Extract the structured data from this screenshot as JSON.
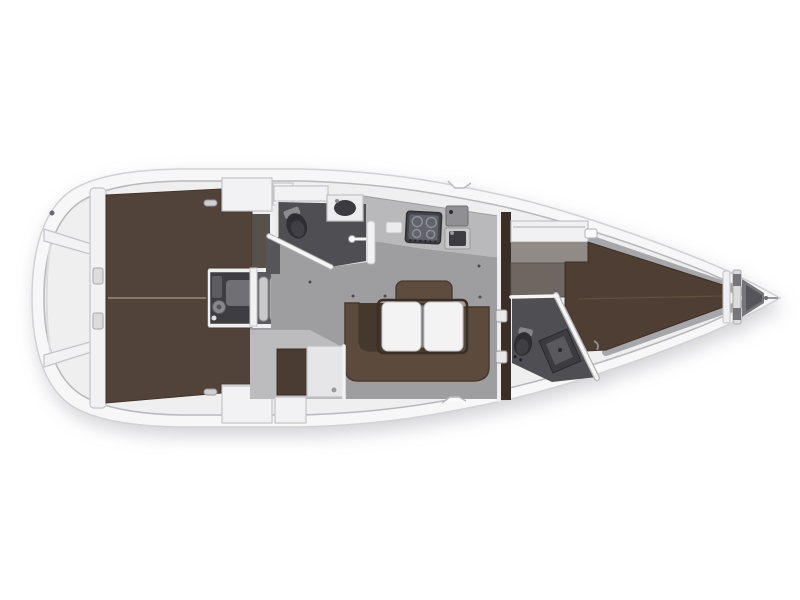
{
  "diagram": {
    "type": "sailing-yacht-interior-floor-plan",
    "view": "top-down",
    "orientation": "bow-right",
    "background": "#ffffff"
  },
  "colors": {
    "hull_white": "#f7f7f8",
    "hull_edge": "#d2d2d6",
    "deck_line": "#b9b9bd",
    "interior_base": "#efeff0",
    "wall_white": "#f2f2f4",
    "wall_stroke": "#c4c4c8",
    "floor_gray": "#9e9ea0",
    "floor_light": "#bcbcbe",
    "head_floor": "#4e4e53",
    "fixture_dark": "#2e2e33",
    "aft_berth_brown": "#52433a",
    "vberth_brown": "#4e3e34",
    "settee_brown": "#5c4a3c",
    "settee_footwell": "#45382c",
    "settee_edge": "#483a2e",
    "backrest_brown": "#5e4c3e",
    "bulkhead_brown": "#3b2e26",
    "nav_seat_brown": "#4b3c33",
    "table_white": "#f3f3f4",
    "counter_gray": "#b9b9bc",
    "stove_dark": "#44444a",
    "engine_dark": "#3e3e42",
    "steps_gray": "#c9c9cb",
    "hull_wall_gray": "#a7a7ab",
    "anchor_gray": "#77777b",
    "wardrobe_gray": "#6e6660",
    "seam_light": "#9a8a7c"
  },
  "vessel": {
    "stern": [
      "swim-platform",
      "transom-bulkhead",
      "stern-lockers"
    ],
    "aft_cabins": [
      "port-double-berth",
      "starboard-double-berth",
      "engine-compartment",
      "companionway-steps",
      "lockers"
    ],
    "saloon": [
      "u-shaped-settee",
      "folding-table",
      "backrest",
      "nav-seat",
      "nav-table",
      "cabin-sole"
    ],
    "galley": [
      "counter",
      "stove",
      "sink",
      "top-loading-fridge"
    ],
    "heads": [
      "aft-head-toilet",
      "aft-head-sink",
      "aft-head-shower-mixer",
      "forward-head-toilet",
      "forward-head-sink"
    ],
    "forward_cabin": [
      "v-berth",
      "shelf",
      "wardrobe",
      "bulkhead-door"
    ],
    "bow": [
      "chain-locker",
      "bow-fitting"
    ]
  }
}
